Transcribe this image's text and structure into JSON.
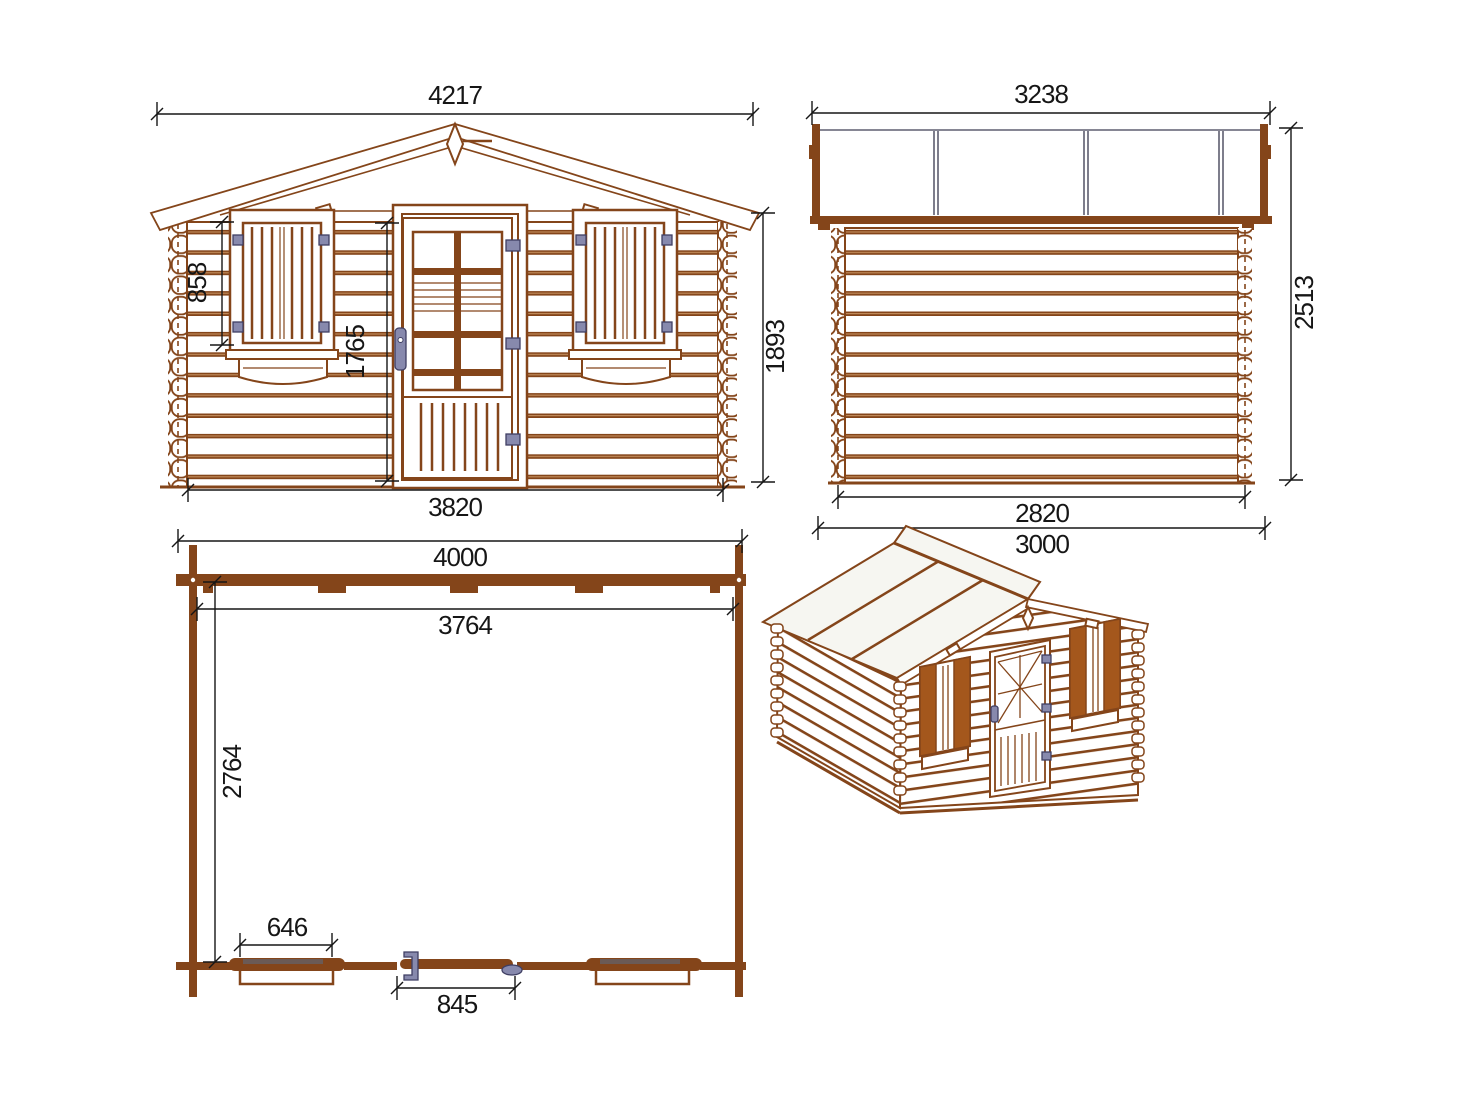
{
  "drawing_title": "log-cabin-technical-drawing",
  "colors": {
    "wood_line": "#84451a",
    "shutter_fill": "#a4571c",
    "hardware": "#8789ad",
    "hardware_outline": "#3f3f63",
    "roof_edge_gray": "#5e5e70",
    "dimension": "#161616",
    "roof_panel": "#f6f6f1",
    "background": "#ffffff"
  },
  "views": {
    "front": {
      "label": "front-elevation",
      "dims": {
        "total_width": "4217",
        "window_height": "858",
        "door_height": "1765",
        "wall_height": "1893",
        "base_width": "3820"
      }
    },
    "side": {
      "label": "side-elevation",
      "dims": {
        "roof_depth": "3238",
        "total_height": "2513",
        "wall_depth": "2820",
        "base_depth": "3000"
      }
    },
    "plan": {
      "label": "floor-plan",
      "dims": {
        "outer_width": "4000",
        "inner_width": "3764",
        "inner_depth": "2764",
        "window_width": "646",
        "door_width": "845"
      }
    },
    "iso": {
      "label": "3d-perspective-view"
    }
  }
}
